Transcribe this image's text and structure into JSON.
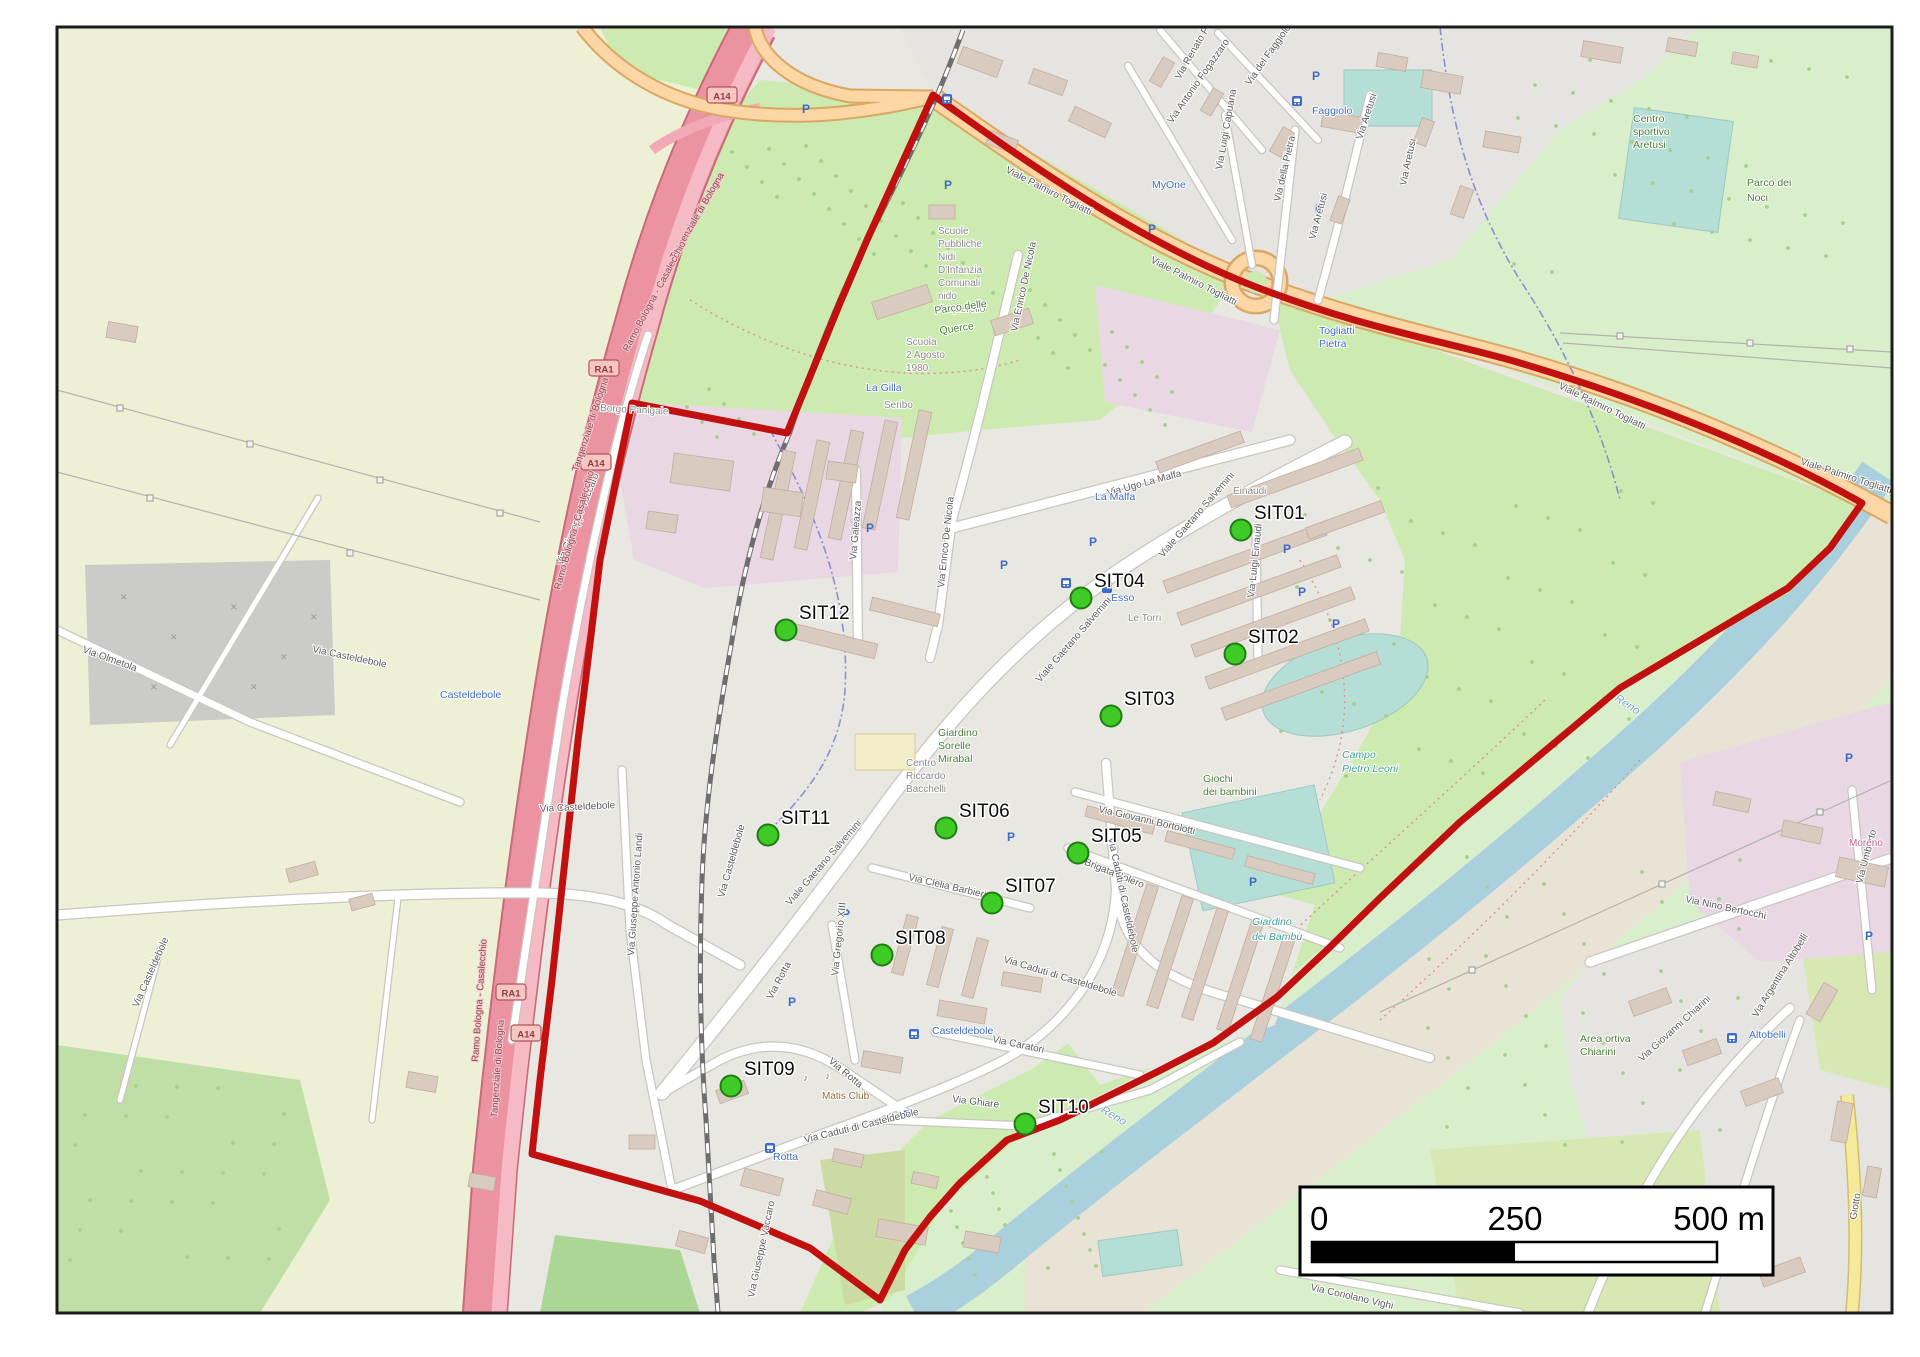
{
  "palette": {
    "boundary_red": "#c01010",
    "marker_fill": "#3fcb25",
    "marker_stroke": "#1f7d14",
    "water_blue": "#aad0de",
    "park_green": "#cdebb0",
    "farmland": "#eef0d5",
    "motorway_pink": "#ec93a2",
    "primary_orange": "#fcd6a4",
    "urban_grey": "#e9e7e2"
  },
  "markers": {
    "label_offset": [
      13,
      -11
    ],
    "items": [
      {
        "id": "SIT01",
        "x": 1241,
        "y": 530
      },
      {
        "id": "SIT02",
        "x": 1235,
        "y": 654
      },
      {
        "id": "SIT03",
        "x": 1111,
        "y": 716
      },
      {
        "id": "SIT04",
        "x": 1081,
        "y": 598
      },
      {
        "id": "SIT05",
        "x": 1078,
        "y": 853
      },
      {
        "id": "SIT06",
        "x": 946,
        "y": 828
      },
      {
        "id": "SIT07",
        "x": 992,
        "y": 903
      },
      {
        "id": "SIT08",
        "x": 882,
        "y": 955
      },
      {
        "id": "SIT09",
        "x": 731,
        "y": 1086
      },
      {
        "id": "SIT10",
        "x": 1025,
        "y": 1124
      },
      {
        "id": "SIT11",
        "x": 768,
        "y": 835
      },
      {
        "id": "SIT12",
        "x": 786,
        "y": 630
      }
    ]
  },
  "scalebar": {
    "ticks": [
      "0",
      "250",
      "500 m"
    ]
  },
  "shields": [
    {
      "t": "A14",
      "x": 722,
      "y": 96
    },
    {
      "t": "A14",
      "x": 596,
      "y": 463
    },
    {
      "t": "A14",
      "x": 526,
      "y": 1034
    },
    {
      "t": "RA1",
      "x": 604,
      "y": 369
    },
    {
      "t": "RA1",
      "x": 511,
      "y": 993
    }
  ],
  "icons": {
    "parking_glyph": "P",
    "music_glyph": "♪",
    "parking_positions": [
      [
        806,
        113
      ],
      [
        948,
        189
      ],
      [
        1152,
        233
      ],
      [
        1316,
        80
      ],
      [
        1319,
        213
      ],
      [
        870,
        532
      ],
      [
        1004,
        569
      ],
      [
        1093,
        546
      ],
      [
        1287,
        553
      ],
      [
        1302,
        596
      ],
      [
        1336,
        628
      ],
      [
        1011,
        841
      ],
      [
        846,
        918
      ],
      [
        792,
        1006
      ],
      [
        907,
        1119
      ],
      [
        1253,
        886
      ],
      [
        1849,
        762
      ],
      [
        1869,
        940
      ]
    ],
    "bus_positions": [
      [
        1066,
        583
      ],
      [
        914,
        1034
      ],
      [
        770,
        1148
      ],
      [
        1732,
        1038
      ],
      [
        1297,
        101
      ],
      [
        947,
        99
      ]
    ],
    "fuel_positions": [
      [
        1107,
        587
      ]
    ]
  },
  "labels": [
    {
      "t": "Viale Palmiro Togliatti",
      "x": 1005,
      "y": 172,
      "r": 27,
      "c": "rd"
    },
    {
      "t": "Viale Palmiro Togliatti",
      "x": 1150,
      "y": 262,
      "r": 27,
      "c": "rd"
    },
    {
      "t": "Viale Palmiro Togliatti",
      "x": 1558,
      "y": 388,
      "r": 26,
      "c": "rd"
    },
    {
      "t": "Viale Palmiro Togliatti",
      "x": 1800,
      "y": 464,
      "r": 18,
      "c": "rd"
    },
    {
      "t": "Via Ugo La Malfa",
      "x": 1108,
      "y": 496,
      "r": -15,
      "c": "rd"
    },
    {
      "t": "Viale Gaetano Salvemini",
      "x": 1163,
      "y": 558,
      "r": -49,
      "c": "rd"
    },
    {
      "t": "Viale Gaetano Salvemini",
      "x": 1040,
      "y": 683,
      "r": -49,
      "c": "rd"
    },
    {
      "t": "Viale Gaetano Salvemini",
      "x": 790,
      "y": 906,
      "r": -49,
      "c": "rd"
    },
    {
      "t": "Via Enrico De Nicola",
      "x": 944,
      "y": 588,
      "r": -84,
      "c": "rd"
    },
    {
      "t": "Via Enrico De Nicola",
      "x": 1017,
      "y": 332,
      "r": -78,
      "c": "rd"
    },
    {
      "t": "Via Galeazza",
      "x": 856,
      "y": 560,
      "r": -85,
      "c": "rd"
    },
    {
      "t": "Via Luigi Einaudi",
      "x": 1254,
      "y": 598,
      "r": -84,
      "c": "rd"
    },
    {
      "t": "Via Giovanni Bortolotti",
      "x": 1098,
      "y": 812,
      "r": 13,
      "c": "rd"
    },
    {
      "t": "Via Brigata Bolero",
      "x": 1068,
      "y": 858,
      "r": 22,
      "c": "rd"
    },
    {
      "t": "Via Clelia Barbieri",
      "x": 908,
      "y": 880,
      "r": 13,
      "c": "rd"
    },
    {
      "t": "Via Caduti di Casteldebole",
      "x": 1108,
      "y": 838,
      "r": 78,
      "c": "rd"
    },
    {
      "t": "Via Caduti di Casteldebole",
      "x": 1003,
      "y": 962,
      "r": 17,
      "c": "rd"
    },
    {
      "t": "Via Caduti di Casteldebole",
      "x": 805,
      "y": 1143,
      "r": -14,
      "c": "rd"
    },
    {
      "t": "Via Gregorio XIII",
      "x": 838,
      "y": 976,
      "r": -84,
      "c": "rd"
    },
    {
      "t": "Via Rotta",
      "x": 772,
      "y": 1000,
      "r": -62,
      "c": "rd"
    },
    {
      "t": "Via Rotta",
      "x": 828,
      "y": 1062,
      "r": 40,
      "c": "rd"
    },
    {
      "t": "Via Caratori",
      "x": 992,
      "y": 1042,
      "r": 12,
      "c": "rd"
    },
    {
      "t": "Via Ghiare",
      "x": 952,
      "y": 1102,
      "r": 7,
      "c": "rd"
    },
    {
      "t": "Via Giuseppe Antonio Landi",
      "x": 634,
      "y": 956,
      "r": -86,
      "c": "rd"
    },
    {
      "t": "Via Giuseppe Vaccaro",
      "x": 562,
      "y": 566,
      "r": -68,
      "c": "rd"
    },
    {
      "t": "Via Giuseppe Vaccaro",
      "x": 754,
      "y": 1298,
      "r": -78,
      "c": "rd"
    },
    {
      "t": "Via Casteldebole",
      "x": 312,
      "y": 652,
      "r": 12,
      "c": "rd"
    },
    {
      "t": "Via Casteldebole",
      "x": 540,
      "y": 812,
      "r": -3,
      "c": "rd"
    },
    {
      "t": "Via Casteldebole",
      "x": 724,
      "y": 898,
      "r": -74,
      "c": "rd"
    },
    {
      "t": "Via Casteldebole",
      "x": 138,
      "y": 1008,
      "r": -66,
      "c": "rd"
    },
    {
      "t": "Via Olmetola",
      "x": 82,
      "y": 652,
      "r": 20,
      "c": "rd"
    },
    {
      "t": "Via Nino Bertocchi",
      "x": 1685,
      "y": 902,
      "r": 12,
      "c": "rd"
    },
    {
      "t": "Via Giovanni Chiarini",
      "x": 1642,
      "y": 1062,
      "r": -42,
      "c": "rd"
    },
    {
      "t": "Via Argentina Altobelli",
      "x": 1757,
      "y": 1018,
      "r": -58,
      "c": "rd"
    },
    {
      "t": "Via Umberto",
      "x": 1862,
      "y": 884,
      "r": -75,
      "c": "rd"
    },
    {
      "t": "Via Coriolano Vighi",
      "x": 1310,
      "y": 1290,
      "r": 13,
      "c": "rd"
    },
    {
      "t": "Via Aretusi",
      "x": 1362,
      "y": 140,
      "r": -72,
      "c": "rd"
    },
    {
      "t": "Via Aretusi",
      "x": 1315,
      "y": 240,
      "r": -75,
      "c": "rd"
    },
    {
      "t": "Via Aretusi",
      "x": 1406,
      "y": 186,
      "r": -78,
      "c": "rd"
    },
    {
      "t": "Via Renato Fucini",
      "x": 1180,
      "y": 80,
      "r": -60,
      "c": "rd"
    },
    {
      "t": "Via Antonio Fogazzaro",
      "x": 1172,
      "y": 124,
      "r": -55,
      "c": "rd"
    },
    {
      "t": "Via Luigi Capuana",
      "x": 1222,
      "y": 170,
      "r": -80,
      "c": "rd"
    },
    {
      "t": "Via del Faggiolo",
      "x": 1250,
      "y": 86,
      "r": -55,
      "c": "rd"
    },
    {
      "t": "Via della Pietra",
      "x": 1280,
      "y": 202,
      "r": -77,
      "c": "rd"
    },
    {
      "t": "Giotto",
      "x": 1856,
      "y": 1220,
      "r": -80,
      "c": "rd"
    },
    {
      "t": "Tangenziale di Bologna",
      "x": 578,
      "y": 472,
      "r": -72,
      "c": "mot"
    },
    {
      "t": "Tangenziale di Bologna",
      "x": 497,
      "y": 1118,
      "r": -86,
      "c": "mot"
    },
    {
      "t": "Tangenziale di Bologna",
      "x": 675,
      "y": 260,
      "r": -60,
      "c": "mot"
    },
    {
      "t": "Ramo Bologna - Casalecchio",
      "x": 628,
      "y": 352,
      "r": -62,
      "c": "mot"
    },
    {
      "t": "Ramo Bologna - Casalecchio",
      "x": 560,
      "y": 590,
      "r": -74,
      "c": "mot"
    },
    {
      "t": "Ramo Bologna - Casalecchio",
      "x": 478,
      "y": 1062,
      "r": -86,
      "c": "mot"
    },
    {
      "t": "Faggiolo",
      "x": 1312,
      "y": 114,
      "r": 0,
      "c": "blu"
    },
    {
      "t": "MyOne",
      "x": 1152,
      "y": 188,
      "r": 0,
      "c": "blu"
    },
    {
      "t": "La Malfa",
      "x": 1095,
      "y": 500,
      "r": 0,
      "c": "blu"
    },
    {
      "t": "La Gilla",
      "x": 866,
      "y": 391,
      "r": 0,
      "c": "blu"
    },
    {
      "t": "Esso",
      "x": 1111,
      "y": 601,
      "r": 0,
      "c": "blu"
    },
    {
      "t": "Casteldebole",
      "x": 932,
      "y": 1034,
      "r": 0,
      "c": "blu"
    },
    {
      "t": "Casteldebole",
      "x": 440,
      "y": 698,
      "r": 0,
      "c": "blu"
    },
    {
      "t": "Rotta",
      "x": 773,
      "y": 1160,
      "r": 0,
      "c": "blu"
    },
    {
      "t": "Altobelli",
      "x": 1749,
      "y": 1038,
      "r": 0,
      "c": "blu"
    },
    {
      "t": "Togliatti",
      "x": 1319,
      "y": 334,
      "r": 0,
      "c": "blu"
    },
    {
      "t": "Pietra",
      "x": 1319,
      "y": 347,
      "r": 0,
      "c": "blu"
    },
    {
      "t": "Einaudi",
      "x": 1233,
      "y": 494,
      "r": 0,
      "c": "poi"
    },
    {
      "t": "Le Torri",
      "x": 1128,
      "y": 621,
      "r": 0,
      "c": "poi"
    },
    {
      "t": "Borgo Panigale",
      "x": 600,
      "y": 411,
      "r": 3,
      "c": "poi"
    },
    {
      "t": "Scuole",
      "x": 938,
      "y": 234,
      "r": 0,
      "c": "poi"
    },
    {
      "t": "Pubbliche",
      "x": 938,
      "y": 247,
      "r": 0,
      "c": "poi"
    },
    {
      "t": "Nidi",
      "x": 938,
      "y": 260,
      "r": 0,
      "c": "poi"
    },
    {
      "t": "D'Infanzia",
      "x": 938,
      "y": 273,
      "r": 0,
      "c": "poi"
    },
    {
      "t": "Comunali",
      "x": 938,
      "y": 286,
      "r": 0,
      "c": "poi"
    },
    {
      "t": "nido",
      "x": 938,
      "y": 299,
      "r": 0,
      "c": "poi"
    },
    {
      "t": "Acquerello",
      "x": 938,
      "y": 312,
      "r": 0,
      "c": "poi"
    },
    {
      "t": "Scuola",
      "x": 906,
      "y": 345,
      "r": 0,
      "c": "poi"
    },
    {
      "t": "2 Agosto",
      "x": 906,
      "y": 358,
      "r": 0,
      "c": "poi"
    },
    {
      "t": "1980",
      "x": 906,
      "y": 371,
      "r": 0,
      "c": "poi"
    },
    {
      "t": "Seribo",
      "x": 884,
      "y": 408,
      "r": 0,
      "c": "poi"
    },
    {
      "t": "Centro",
      "x": 906,
      "y": 766,
      "r": 0,
      "c": "poi"
    },
    {
      "t": "Riccardo",
      "x": 906,
      "y": 779,
      "r": 0,
      "c": "poi"
    },
    {
      "t": "Bacchelli",
      "x": 906,
      "y": 792,
      "r": 0,
      "c": "poi"
    },
    {
      "t": "Matis Club",
      "x": 822,
      "y": 1099,
      "r": 0,
      "c": "brn"
    },
    {
      "t": "Parco delle",
      "x": 935,
      "y": 314,
      "r": -8,
      "c": "prk"
    },
    {
      "t": "Querce",
      "x": 940,
      "y": 334,
      "r": -8,
      "c": "prk"
    },
    {
      "t": "Parco dei",
      "x": 1747,
      "y": 186,
      "r": 0,
      "c": "prk"
    },
    {
      "t": "Noci",
      "x": 1747,
      "y": 201,
      "r": 0,
      "c": "prk"
    },
    {
      "t": "Centro",
      "x": 1633,
      "y": 122,
      "r": 0,
      "c": "prk"
    },
    {
      "t": "sportivo",
      "x": 1633,
      "y": 135,
      "r": 0,
      "c": "prk"
    },
    {
      "t": "Aretusi",
      "x": 1633,
      "y": 148,
      "r": 0,
      "c": "prk"
    },
    {
      "t": "Giardino",
      "x": 938,
      "y": 736,
      "r": 0,
      "c": "prk"
    },
    {
      "t": "Sorelle",
      "x": 938,
      "y": 749,
      "r": 0,
      "c": "prk"
    },
    {
      "t": "Mirabal",
      "x": 938,
      "y": 762,
      "r": 0,
      "c": "prk"
    },
    {
      "t": "Giochi",
      "x": 1203,
      "y": 782,
      "r": 0,
      "c": "prk"
    },
    {
      "t": "dei bambini",
      "x": 1203,
      "y": 795,
      "r": 0,
      "c": "prk"
    },
    {
      "t": "Area ortiva",
      "x": 1580,
      "y": 1042,
      "r": 0,
      "c": "prk"
    },
    {
      "t": "Chiarini",
      "x": 1580,
      "y": 1055,
      "r": 0,
      "c": "prk"
    },
    {
      "t": "Campo",
      "x": 1342,
      "y": 758,
      "r": 0,
      "c": "tea"
    },
    {
      "t": "Pietro Leoni",
      "x": 1342,
      "y": 772,
      "r": 0,
      "c": "tea"
    },
    {
      "t": "Giardino",
      "x": 1252,
      "y": 925,
      "r": 0,
      "c": "tea"
    },
    {
      "t": "dei Bambù",
      "x": 1252,
      "y": 940,
      "r": 0,
      "c": "tea"
    },
    {
      "t": "Reno",
      "x": 1614,
      "y": 700,
      "r": 33,
      "c": "wat"
    },
    {
      "t": "Reno",
      "x": 1100,
      "y": 1112,
      "r": 30,
      "c": "wat"
    },
    {
      "t": "Moreno",
      "x": 1849,
      "y": 846,
      "r": 0,
      "c": "pnk"
    }
  ]
}
